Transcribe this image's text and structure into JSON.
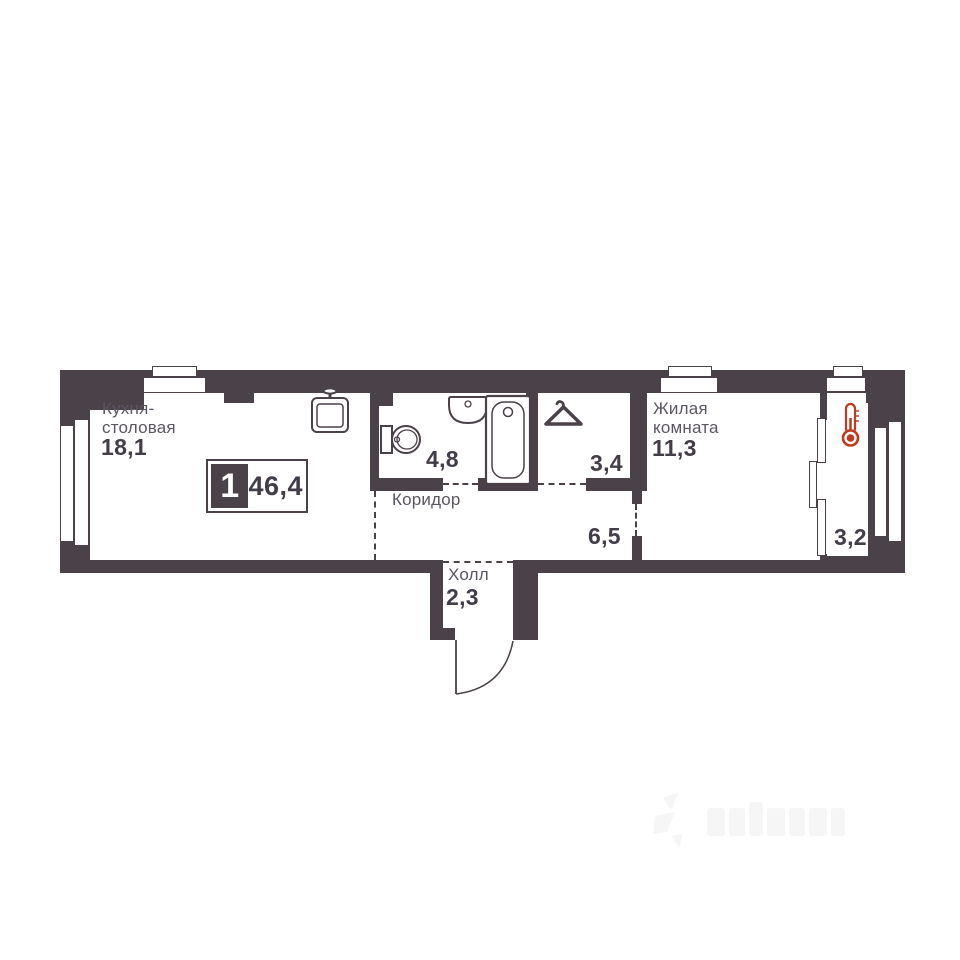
{
  "plan": {
    "badge": {
      "rooms_count": "1",
      "total_area": "46,4"
    },
    "rooms": {
      "kitchen": {
        "name": "Кухня-столовая",
        "area": "18,1"
      },
      "bathroom": {
        "area": "4,8"
      },
      "wardrobe": {
        "area": "3,4"
      },
      "living": {
        "name": "Жилая комната",
        "area": "11,3"
      },
      "corridor": {
        "name": "Коридор",
        "area": "6,5"
      },
      "hall": {
        "name": "Холл",
        "area": "2,3"
      },
      "balcony": {
        "area": "3,2"
      }
    },
    "icons": {
      "kitchen_sink": "kitchen-sink-icon",
      "toilet": "toilet-icon",
      "washbasin": "washbasin-icon",
      "bathtub": "bathtub-icon",
      "hanger": "hanger-icon",
      "thermometer": "thermometer-icon",
      "entrance_door": "entrance-door-arc"
    },
    "colors": {
      "wall": "#4a4149",
      "room_name_text": "#5c5662",
      "area_text": "#433c49",
      "thermometer_red": "#c03a20",
      "background": "#ffffff"
    },
    "watermark": {
      "legible": false
    }
  }
}
